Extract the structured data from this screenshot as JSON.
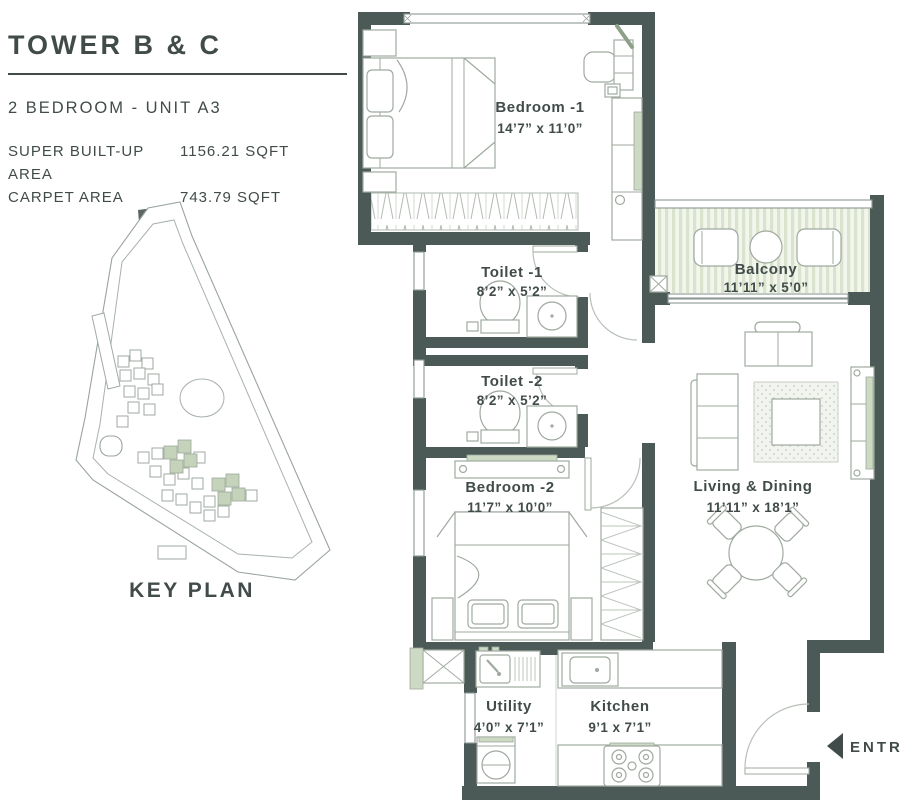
{
  "header": {
    "title": "TOWER B & C",
    "subtitle": "2 BEDROOM - UNIT A3",
    "areas": [
      {
        "label": "SUPER BUILT-UP AREA",
        "value": "1156.21 SQFT"
      },
      {
        "label": "CARPET AREA",
        "value": "743.79 SQFT"
      }
    ]
  },
  "key_plan": {
    "label": "KEY PLAN"
  },
  "rooms": [
    {
      "name": "Bedroom -1",
      "dims": "14’7” x 11’0”"
    },
    {
      "name": "Balcony",
      "dims": "11’11” x 5’0”"
    },
    {
      "name": "Toilet -1",
      "dims": "8’2” x 5’2”"
    },
    {
      "name": "Toilet -2",
      "dims": "8’2” x 5’2”"
    },
    {
      "name": "Bedroom -2",
      "dims": "11’7” x 10’0”"
    },
    {
      "name": "Living & Dining",
      "dims": "11’11” x 18’1”"
    },
    {
      "name": "Utility",
      "dims": "4’0” x 7’1”"
    },
    {
      "name": "Kitchen",
      "dims": "9’1 x 7’1”"
    }
  ],
  "entry": {
    "label": "ENTRY"
  },
  "colors": {
    "wall": "#4b5a57",
    "text": "#414c4a",
    "furn": "#9fa99f",
    "green": "#ccd9c3"
  }
}
